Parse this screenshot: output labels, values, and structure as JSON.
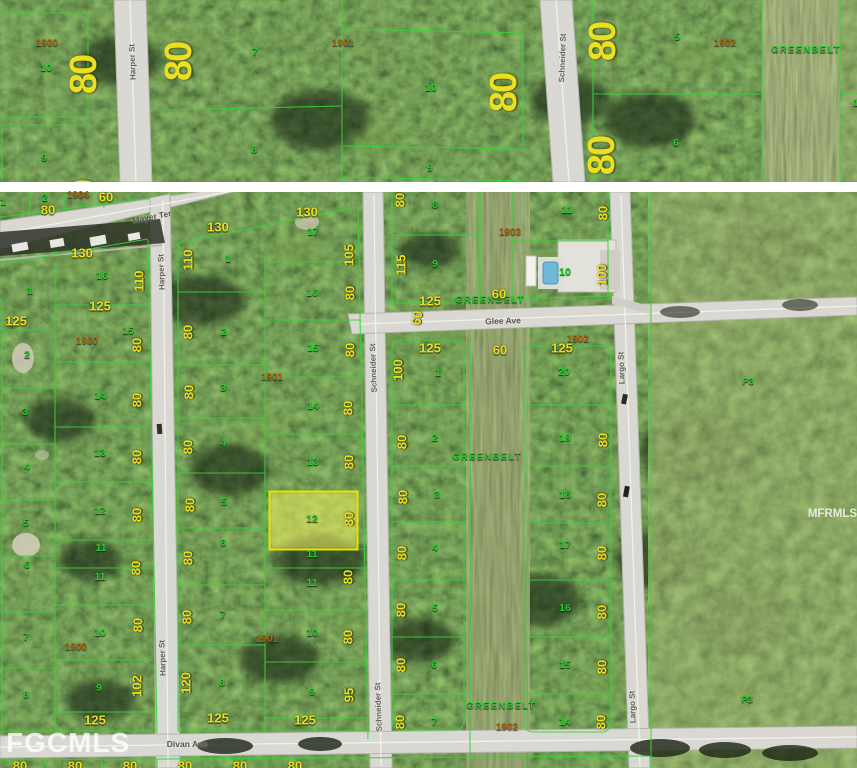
{
  "map_title": "Aerial parcel map with highlighted lot",
  "watermarks": {
    "bottom_left": "FGCMLS",
    "right": "MFRMLS"
  },
  "streets": [
    "Mayer Ter",
    "Harper St",
    "Schneider St",
    "Glee Ave",
    "Divan Ave",
    "Largo St"
  ],
  "highlighted_parcel": {
    "lot": "12",
    "outline": "#e8e400",
    "fill": "rgba(232,232,70,0.5)"
  },
  "colors": {
    "lot_line": "#39d23c",
    "dimension_text": "#ecdf1f",
    "lot_text": "#2bc92f",
    "plat_text": "#a96418",
    "road": "#d9d8d2",
    "greenbelt_text": "#2bc92f"
  },
  "labels_top": [
    {
      "t": "1900",
      "x": 47,
      "y": 44,
      "c": "plat"
    },
    {
      "t": "10",
      "x": 46,
      "y": 68,
      "c": "lot"
    },
    {
      "t": "80",
      "x": 84,
      "y": 75,
      "r": -90,
      "c": "dimL"
    },
    {
      "t": "9",
      "x": 44,
      "y": 158,
      "c": "lot"
    },
    {
      "t": "80",
      "x": 84,
      "y": 200,
      "r": -90,
      "c": "dimL"
    },
    {
      "t": "80",
      "x": 182,
      "y": 206,
      "r": -90,
      "c": "dimL"
    },
    {
      "t": "Harper St",
      "x": 133,
      "y": 62,
      "r": -92,
      "c": "stv"
    },
    {
      "t": "80",
      "x": 179,
      "y": 62,
      "r": -90,
      "c": "dimL"
    },
    {
      "t": "7",
      "x": 255,
      "y": 52,
      "c": "lot"
    },
    {
      "t": "8",
      "x": 254,
      "y": 150,
      "c": "lot"
    },
    {
      "t": "1901",
      "x": 343,
      "y": 44,
      "c": "plat"
    },
    {
      "t": "10",
      "x": 431,
      "y": 88,
      "c": "lot"
    },
    {
      "t": "80",
      "x": 504,
      "y": 93,
      "r": -90,
      "c": "dimL"
    },
    {
      "t": "9",
      "x": 430,
      "y": 168,
      "c": "lot"
    },
    {
      "t": "80",
      "x": 547,
      "y": 202,
      "r": -90,
      "c": "dimL"
    },
    {
      "t": "Schneider St",
      "x": 563,
      "y": 58,
      "r": -88,
      "c": "stv"
    },
    {
      "t": "80",
      "x": 603,
      "y": 42,
      "r": -90,
      "c": "dimL"
    },
    {
      "t": "5",
      "x": 677,
      "y": 37,
      "c": "lot"
    },
    {
      "t": "1902",
      "x": 725,
      "y": 44,
      "c": "plat"
    },
    {
      "t": "GREENBELT",
      "x": 806,
      "y": 50,
      "c": "gb"
    },
    {
      "t": "80",
      "x": 602,
      "y": 156,
      "r": -90,
      "c": "dimL"
    },
    {
      "t": "6",
      "x": 676,
      "y": 143,
      "c": "lot"
    },
    {
      "t": "1",
      "x": 856,
      "y": 103,
      "c": "lot"
    }
  ],
  "labels": [
    {
      "t": "1",
      "x": 3,
      "y": 202,
      "c": "lot"
    },
    {
      "t": "2",
      "x": 45,
      "y": 198,
      "c": "lot"
    },
    {
      "t": "80",
      "x": 48,
      "y": 210,
      "c": "dim"
    },
    {
      "t": "1904",
      "x": 78,
      "y": 196,
      "c": "plat"
    },
    {
      "t": "60",
      "x": 106,
      "y": 197,
      "c": "dim"
    },
    {
      "t": "Mayer Ter",
      "x": 152,
      "y": 217,
      "r": -11,
      "c": "st"
    },
    {
      "t": "130",
      "x": 82,
      "y": 253,
      "c": "dim"
    },
    {
      "t": "1",
      "x": 30,
      "y": 291,
      "c": "lot"
    },
    {
      "t": "125",
      "x": 16,
      "y": 321,
      "c": "dim"
    },
    {
      "t": "125",
      "x": 100,
      "y": 306,
      "c": "dim"
    },
    {
      "t": "16",
      "x": 102,
      "y": 276,
      "c": "lot"
    },
    {
      "t": "110",
      "x": 139,
      "y": 281,
      "r": -90,
      "c": "dim"
    },
    {
      "t": "15",
      "x": 128,
      "y": 331,
      "c": "lot"
    },
    {
      "t": "80",
      "x": 137,
      "y": 345,
      "r": -90,
      "c": "dim"
    },
    {
      "t": "1900",
      "x": 87,
      "y": 342,
      "c": "plat"
    },
    {
      "t": "2",
      "x": 27,
      "y": 355,
      "c": "lot"
    },
    {
      "t": "3",
      "x": 25,
      "y": 412,
      "c": "lot"
    },
    {
      "t": "4",
      "x": 27,
      "y": 467,
      "c": "lot"
    },
    {
      "t": "5",
      "x": 26,
      "y": 523,
      "c": "lot"
    },
    {
      "t": "6",
      "x": 27,
      "y": 565,
      "c": "lot"
    },
    {
      "t": "7",
      "x": 26,
      "y": 637,
      "c": "lot"
    },
    {
      "t": "8",
      "x": 26,
      "y": 695,
      "c": "lot"
    },
    {
      "t": "14",
      "x": 100,
      "y": 396,
      "c": "lot"
    },
    {
      "t": "13",
      "x": 100,
      "y": 453,
      "c": "lot"
    },
    {
      "t": "12",
      "x": 100,
      "y": 511,
      "c": "lot"
    },
    {
      "t": "11",
      "x": 101,
      "y": 548,
      "c": "lot"
    },
    {
      "t": "11",
      "x": 100,
      "y": 577,
      "c": "lot"
    },
    {
      "t": "10",
      "x": 100,
      "y": 633,
      "c": "lot"
    },
    {
      "t": "9",
      "x": 99,
      "y": 688,
      "c": "lot"
    },
    {
      "t": "1900",
      "x": 76,
      "y": 648,
      "c": "plat"
    },
    {
      "t": "80",
      "x": 137,
      "y": 400,
      "r": -90,
      "c": "dim"
    },
    {
      "t": "80",
      "x": 137,
      "y": 457,
      "r": -90,
      "c": "dim"
    },
    {
      "t": "80",
      "x": 137,
      "y": 515,
      "r": -90,
      "c": "dim"
    },
    {
      "t": "80",
      "x": 136,
      "y": 568,
      "r": -90,
      "c": "dim"
    },
    {
      "t": "80",
      "x": 138,
      "y": 625,
      "r": -90,
      "c": "dim"
    },
    {
      "t": "102",
      "x": 137,
      "y": 686,
      "r": -90,
      "c": "dim"
    },
    {
      "t": "125",
      "x": 95,
      "y": 720,
      "c": "dim"
    },
    {
      "t": "Harper St",
      "x": 162,
      "y": 272,
      "r": -92,
      "c": "stv"
    },
    {
      "t": "Harper St",
      "x": 163,
      "y": 658,
      "r": -92,
      "c": "stv"
    },
    {
      "t": "130",
      "x": 218,
      "y": 227,
      "c": "dim"
    },
    {
      "t": "110",
      "x": 188,
      "y": 260,
      "r": -90,
      "c": "dim"
    },
    {
      "t": "1",
      "x": 228,
      "y": 259,
      "c": "lot"
    },
    {
      "t": "80",
      "x": 188,
      "y": 332,
      "r": -90,
      "c": "dim"
    },
    {
      "t": "2",
      "x": 224,
      "y": 332,
      "c": "lot"
    },
    {
      "t": "1901",
      "x": 272,
      "y": 378,
      "c": "plat"
    },
    {
      "t": "3",
      "x": 223,
      "y": 388,
      "c": "lot"
    },
    {
      "t": "80",
      "x": 189,
      "y": 392,
      "r": -90,
      "c": "dim"
    },
    {
      "t": "80",
      "x": 188,
      "y": 447,
      "r": -90,
      "c": "dim"
    },
    {
      "t": "4",
      "x": 223,
      "y": 443,
      "c": "lot"
    },
    {
      "t": "80",
      "x": 190,
      "y": 505,
      "r": -90,
      "c": "dim"
    },
    {
      "t": "5",
      "x": 224,
      "y": 502,
      "c": "lot"
    },
    {
      "t": "80",
      "x": 188,
      "y": 558,
      "r": -90,
      "c": "dim"
    },
    {
      "t": "6",
      "x": 223,
      "y": 543,
      "c": "lot"
    },
    {
      "t": "80",
      "x": 187,
      "y": 617,
      "r": -90,
      "c": "dim"
    },
    {
      "t": "7",
      "x": 223,
      "y": 615,
      "c": "lot"
    },
    {
      "t": "120",
      "x": 186,
      "y": 683,
      "r": -90,
      "c": "dim"
    },
    {
      "t": "8",
      "x": 222,
      "y": 683,
      "c": "lot"
    },
    {
      "t": "1901",
      "x": 267,
      "y": 640,
      "c": "plat"
    },
    {
      "t": "125",
      "x": 218,
      "y": 718,
      "c": "dim"
    },
    {
      "t": "130",
      "x": 307,
      "y": 212,
      "c": "dim"
    },
    {
      "t": "17",
      "x": 313,
      "y": 232,
      "c": "lot"
    },
    {
      "t": "105",
      "x": 349,
      "y": 255,
      "r": -90,
      "c": "dim"
    },
    {
      "t": "16",
      "x": 312,
      "y": 293,
      "c": "lot"
    },
    {
      "t": "80",
      "x": 350,
      "y": 293,
      "r": -90,
      "c": "dim"
    },
    {
      "t": "15",
      "x": 313,
      "y": 348,
      "c": "lot"
    },
    {
      "t": "80",
      "x": 350,
      "y": 350,
      "r": -90,
      "c": "dim"
    },
    {
      "t": "14",
      "x": 313,
      "y": 406,
      "c": "lot"
    },
    {
      "t": "80",
      "x": 348,
      "y": 408,
      "r": -90,
      "c": "dim"
    },
    {
      "t": "13",
      "x": 313,
      "y": 462,
      "c": "lot"
    },
    {
      "t": "80",
      "x": 349,
      "y": 462,
      "r": -90,
      "c": "dim"
    },
    {
      "t": "12",
      "x": 312,
      "y": 519,
      "c": "lot"
    },
    {
      "t": "80",
      "x": 349,
      "y": 519,
      "r": -90,
      "c": "dim"
    },
    {
      "t": "11",
      "x": 312,
      "y": 554,
      "c": "lot"
    },
    {
      "t": "11",
      "x": 312,
      "y": 583,
      "c": "lot"
    },
    {
      "t": "80",
      "x": 348,
      "y": 577,
      "r": -90,
      "c": "dim"
    },
    {
      "t": "10",
      "x": 312,
      "y": 633,
      "c": "lot"
    },
    {
      "t": "80",
      "x": 348,
      "y": 637,
      "r": -90,
      "c": "dim"
    },
    {
      "t": "9",
      "x": 312,
      "y": 692,
      "c": "lot"
    },
    {
      "t": "95",
      "x": 349,
      "y": 695,
      "r": -90,
      "c": "dim"
    },
    {
      "t": "125",
      "x": 305,
      "y": 720,
      "c": "dim"
    },
    {
      "t": "Schneider St",
      "x": 374,
      "y": 368,
      "r": -92,
      "c": "stv"
    },
    {
      "t": "Schneider St",
      "x": 379,
      "y": 707,
      "r": -92,
      "c": "stv"
    },
    {
      "t": "60",
      "x": 417,
      "y": 318,
      "r": -80,
      "c": "dim"
    },
    {
      "t": "80",
      "x": 400,
      "y": 200,
      "r": -90,
      "c": "dim"
    },
    {
      "t": "8",
      "x": 435,
      "y": 205,
      "c": "lot"
    },
    {
      "t": "115",
      "x": 401,
      "y": 265,
      "r": -90,
      "c": "dim"
    },
    {
      "t": "9",
      "x": 435,
      "y": 264,
      "c": "lot"
    },
    {
      "t": "125",
      "x": 430,
      "y": 301,
      "c": "dim"
    },
    {
      "t": "GREENBELT",
      "x": 490,
      "y": 300,
      "c": "gb"
    },
    {
      "t": "60",
      "x": 499,
      "y": 294,
      "c": "dim"
    },
    {
      "t": "1903",
      "x": 510,
      "y": 233,
      "c": "plat"
    },
    {
      "t": "11",
      "x": 567,
      "y": 210,
      "c": "lot"
    },
    {
      "t": "80",
      "x": 603,
      "y": 213,
      "r": -90,
      "c": "dim"
    },
    {
      "t": "10",
      "x": 565,
      "y": 272,
      "c": "lot"
    },
    {
      "t": "100",
      "x": 602,
      "y": 275,
      "r": -90,
      "c": "dim"
    },
    {
      "t": "Glee Ave",
      "x": 503,
      "y": 321,
      "r": -2,
      "c": "st"
    },
    {
      "t": "125",
      "x": 430,
      "y": 348,
      "c": "dim"
    },
    {
      "t": "100",
      "x": 398,
      "y": 370,
      "r": -90,
      "c": "dim"
    },
    {
      "t": "1",
      "x": 438,
      "y": 373,
      "c": "lot"
    },
    {
      "t": "60",
      "x": 500,
      "y": 350,
      "c": "dim"
    },
    {
      "t": "125",
      "x": 562,
      "y": 348,
      "c": "dim"
    },
    {
      "t": "1902",
      "x": 578,
      "y": 340,
      "c": "plat"
    },
    {
      "t": "20",
      "x": 564,
      "y": 372,
      "c": "lot"
    },
    {
      "t": "80",
      "x": 402,
      "y": 442,
      "r": -90,
      "c": "dim"
    },
    {
      "t": "2",
      "x": 435,
      "y": 438,
      "c": "lot"
    },
    {
      "t": "80",
      "x": 403,
      "y": 497,
      "r": -90,
      "c": "dim"
    },
    {
      "t": "3",
      "x": 437,
      "y": 495,
      "c": "lot"
    },
    {
      "t": "80",
      "x": 402,
      "y": 553,
      "r": -90,
      "c": "dim"
    },
    {
      "t": "4",
      "x": 435,
      "y": 548,
      "c": "lot"
    },
    {
      "t": "80",
      "x": 401,
      "y": 610,
      "r": -90,
      "c": "dim"
    },
    {
      "t": "5",
      "x": 435,
      "y": 608,
      "c": "lot"
    },
    {
      "t": "80",
      "x": 401,
      "y": 665,
      "r": -90,
      "c": "dim"
    },
    {
      "t": "6",
      "x": 434,
      "y": 665,
      "c": "lot"
    },
    {
      "t": "80",
      "x": 400,
      "y": 722,
      "r": -90,
      "c": "dim"
    },
    {
      "t": "7",
      "x": 434,
      "y": 722,
      "c": "lot"
    },
    {
      "t": "GREENBELT",
      "x": 487,
      "y": 457,
      "c": "gb"
    },
    {
      "t": "GREENBELT",
      "x": 501,
      "y": 706,
      "c": "gb"
    },
    {
      "t": "1902",
      "x": 507,
      "y": 728,
      "c": "plat"
    },
    {
      "t": "19",
      "x": 565,
      "y": 438,
      "c": "lot"
    },
    {
      "t": "80",
      "x": 603,
      "y": 440,
      "r": -90,
      "c": "dim"
    },
    {
      "t": "18",
      "x": 565,
      "y": 495,
      "c": "lot"
    },
    {
      "t": "80",
      "x": 602,
      "y": 500,
      "r": -90,
      "c": "dim"
    },
    {
      "t": "17",
      "x": 565,
      "y": 545,
      "c": "lot"
    },
    {
      "t": "80",
      "x": 602,
      "y": 553,
      "r": -90,
      "c": "dim"
    },
    {
      "t": "16",
      "x": 565,
      "y": 608,
      "c": "lot"
    },
    {
      "t": "80",
      "x": 602,
      "y": 612,
      "r": -90,
      "c": "dim"
    },
    {
      "t": "15",
      "x": 565,
      "y": 665,
      "c": "lot"
    },
    {
      "t": "80",
      "x": 602,
      "y": 667,
      "r": -90,
      "c": "dim"
    },
    {
      "t": "14",
      "x": 565,
      "y": 722,
      "c": "lot"
    },
    {
      "t": "80",
      "x": 601,
      "y": 722,
      "r": -90,
      "c": "dim"
    },
    {
      "t": "Largo St",
      "x": 622,
      "y": 368,
      "r": -92,
      "c": "stv"
    },
    {
      "t": "Largo St",
      "x": 633,
      "y": 707,
      "r": -92,
      "c": "stv"
    },
    {
      "t": "P3",
      "x": 748,
      "y": 382,
      "c": "p3"
    },
    {
      "t": "P3",
      "x": 747,
      "y": 700,
      "c": "p3"
    },
    {
      "t": "Divan Ave",
      "x": 187,
      "y": 744,
      "c": "st"
    },
    {
      "t": "80",
      "x": 20,
      "y": 766,
      "c": "dim"
    },
    {
      "t": "80",
      "x": 75,
      "y": 766,
      "c": "dim"
    },
    {
      "t": "80",
      "x": 130,
      "y": 766,
      "c": "dim"
    },
    {
      "t": "80",
      "x": 185,
      "y": 766,
      "c": "dim"
    },
    {
      "t": "80",
      "x": 240,
      "y": 766,
      "c": "dim"
    },
    {
      "t": "80",
      "x": 295,
      "y": 766,
      "c": "dim"
    }
  ]
}
